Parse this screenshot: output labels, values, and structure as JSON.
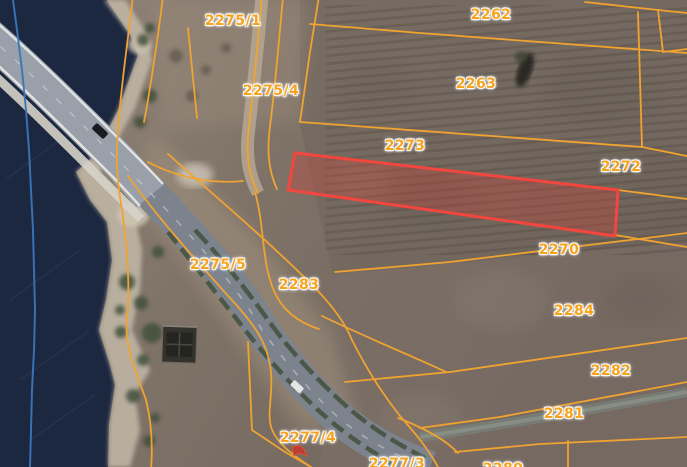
{
  "app": {
    "view": "cadastral-satellite-map"
  },
  "map": {
    "parcel_labels": [
      {
        "id": "2275-1",
        "text": "2275/1"
      },
      {
        "id": "2262",
        "text": "2262"
      },
      {
        "id": "2263",
        "text": "2263"
      },
      {
        "id": "2275-4",
        "text": "2275/4"
      },
      {
        "id": "2273",
        "text": "2273"
      },
      {
        "id": "2272",
        "text": "2272"
      },
      {
        "id": "2270",
        "text": "2270"
      },
      {
        "id": "2275-5",
        "text": "2275/5"
      },
      {
        "id": "2283",
        "text": "2283"
      },
      {
        "id": "2284",
        "text": "2284"
      },
      {
        "id": "2282",
        "text": "2282"
      },
      {
        "id": "2281",
        "text": "2281"
      },
      {
        "id": "2277-4",
        "text": "2277/4"
      },
      {
        "id": "2277-3",
        "text": "2277/3"
      },
      {
        "id": "2280",
        "text": "2280"
      }
    ],
    "selected_parcel": {
      "highlighted": true
    }
  },
  "theme": {
    "label_color": "#F7A41D",
    "parcel_line_color": "#F0A330",
    "selected_stroke": "#F2463E",
    "selected_fill": "rgba(210,68,58,0.33)",
    "admin_line_color": "#3A76B6",
    "water_color": "#1C2740"
  }
}
